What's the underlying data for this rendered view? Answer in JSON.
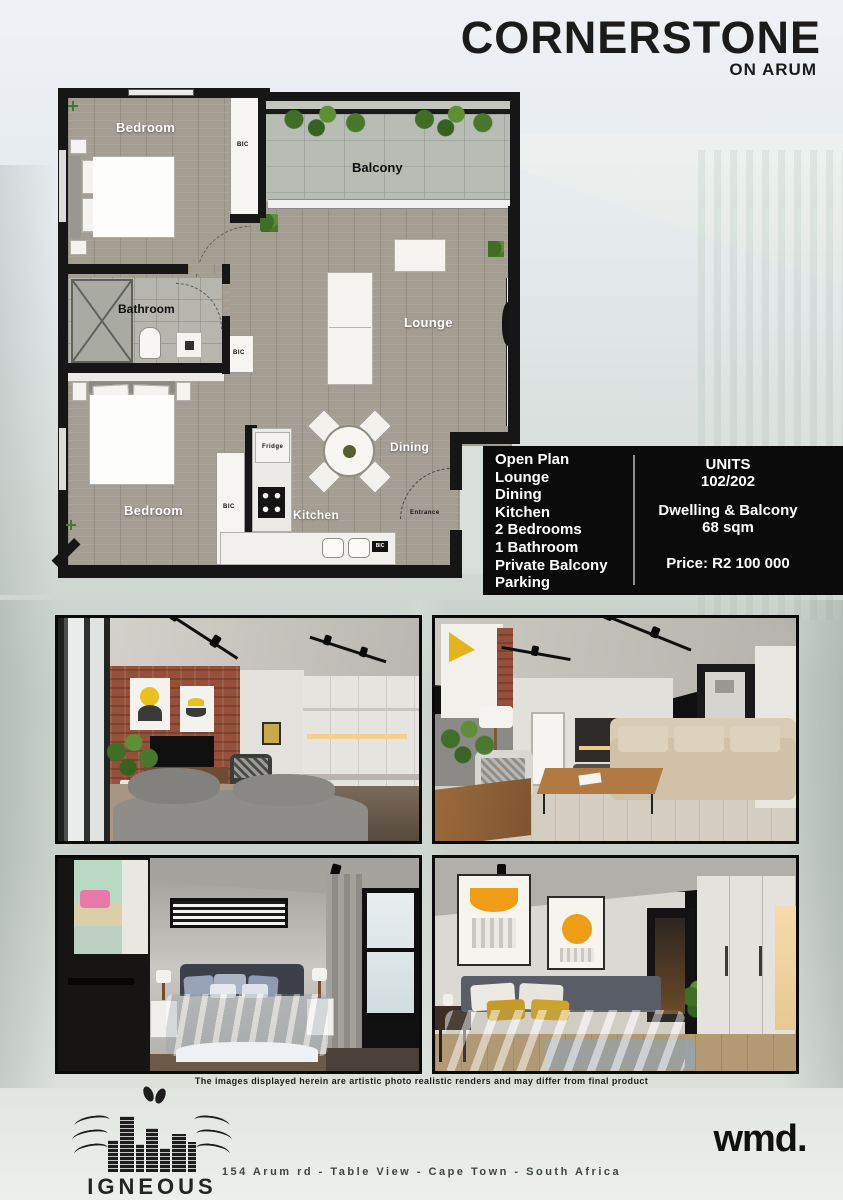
{
  "header": {
    "title": "CORNERSTONE",
    "subtitle": "ON ARUM"
  },
  "floor_plan": {
    "bedroom_top": "Bedroom",
    "balcony": "Balcony",
    "bathroom": "Bathroom",
    "lounge": "Lounge",
    "dining": "Dining",
    "kitchen": "Kitchen",
    "bedroom_bottom": "Bedroom",
    "fridge": "Fridge",
    "entrance": "Entrance",
    "bic": "BIC"
  },
  "features": {
    "items": [
      "Open Plan",
      "Lounge",
      "Dining",
      "Kitchen",
      "2 Bedrooms",
      "1 Bathroom",
      "Private Balcony",
      "Parking"
    ]
  },
  "unit_info": {
    "units_label": "UNITS",
    "units_value": "102/202",
    "size_label": "Dwelling & Balcony",
    "size_value": "68 sqm",
    "price": "Price: R2 100 000"
  },
  "disclaimer": "The images displayed herein are artistic photo realistic renders and may differ from final product",
  "footer": {
    "developer_name": "IGNEOUS",
    "developer_tagline": "PROPERTY DEVELOPMENT",
    "agency_logo": "wmd.",
    "address": "154 Arum rd - Table View - Cape Town - South Africa"
  },
  "colors": {
    "wall": "#161616",
    "wood_floor": "#a49e92",
    "balcony_stone": "#b7bcb4",
    "info_box_bg": "#0b0b0b",
    "plant_green": "#4a7a2c",
    "brick": "#9c5138",
    "title_text": "#1b1b1b"
  }
}
